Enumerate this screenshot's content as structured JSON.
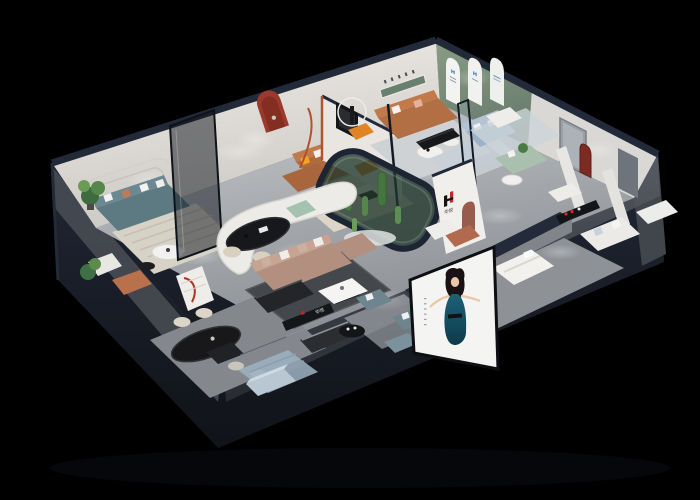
{
  "scene": {
    "type": "3d-isometric-furniture-showroom-render",
    "background_color": "#000000"
  },
  "brand": {
    "logo_mark": "H",
    "name_cn": "华悦",
    "logo_red": "#c0271e",
    "logo_black": "#141414"
  },
  "signs": {
    "interior_wall_logo": "华悦",
    "front_fascia_sign": "华悦",
    "arch_display_mark": "H"
  },
  "palette": {
    "roof_navy": "#222a39",
    "building_mass": "#1c222e",
    "facade_gray": "#4a4e55",
    "floor_gray": "#9b9ea2",
    "wall_white": "#ece9e5",
    "wall_green": "#7c8e80",
    "niche_red": "#9c392b",
    "niche_dark_red": "#7d2a22",
    "accent_orange": "#df8527",
    "leather_caramel": "#b06a3e",
    "sofa_teal": "#5d7a82",
    "sofa_taupe": "#b28f7e",
    "sofa_blue": "#9cb2c8",
    "sofa_bluegray": "#6e8590",
    "sage_green": "#a5c2b0",
    "plant_green": "#4c7a44",
    "poster_dress_teal": "#15566b",
    "table_black": "#141517"
  }
}
